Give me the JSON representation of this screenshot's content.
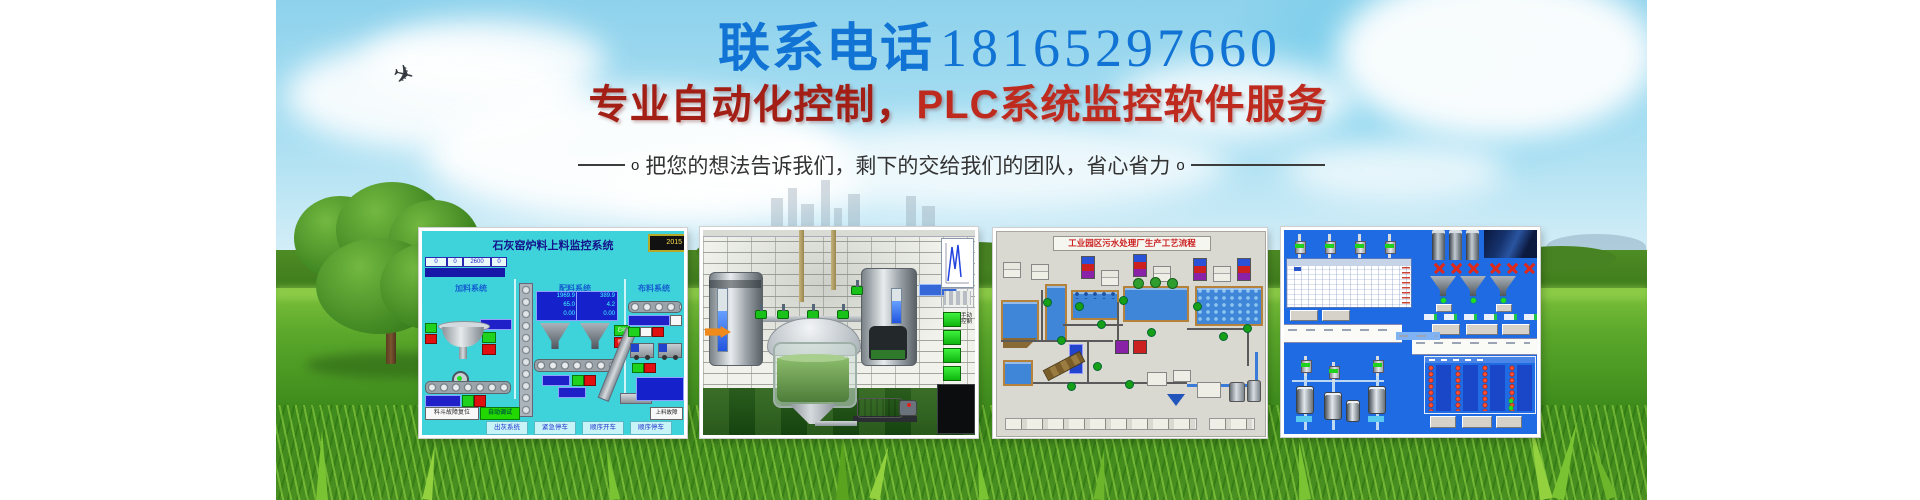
{
  "banner": {
    "phone_prefix": "联系电话",
    "phone_number": "18165297660",
    "headline_part1": "专业自动化控制，",
    "headline_part2": "PLC系统监控软件服务",
    "subtitle": "把您的想法告诉我们，剩下的交给我们的团队，省心省力",
    "subtitle_marker_left": "o",
    "subtitle_marker_right": "o"
  },
  "colors": {
    "phone_blue": "#1173d4",
    "headline_red_dark": "#a31e15",
    "headline_red_bright": "#bf2a1e",
    "subtitle_gray": "#333333",
    "screen1_cyan": "#3ed3da",
    "screen4_blue": "#1f6be4",
    "button_green": "#22d800",
    "button_red": "#e01010",
    "value_box_blue": "#1522cc"
  },
  "screen1": {
    "title": "石灰窑炉料上料监控系统",
    "lcd_value": "2015",
    "top_cells": [
      "0",
      "0",
      "2600",
      "0"
    ],
    "section_feed": "加料系统",
    "section_batch": "配料系统",
    "section_dist": "布料系统",
    "hopper1_values": [
      "1969.9",
      "65.0",
      "0.00"
    ],
    "hopper2_values": [
      "389.9",
      "4.2",
      "0.00"
    ],
    "start_label": "启动",
    "stop_label": "停止",
    "reset_button": "料斗故障复位",
    "auto_button": "自动调试",
    "fault_button": "上料故障",
    "bottom_buttons": [
      "出灰系统",
      "紧急停车",
      "顺序开车",
      "顺序停车"
    ]
  },
  "screen2": {
    "manual_label": "手动控制"
  },
  "screen3": {
    "title": "工业园区污水处理厂生产工艺流程"
  }
}
